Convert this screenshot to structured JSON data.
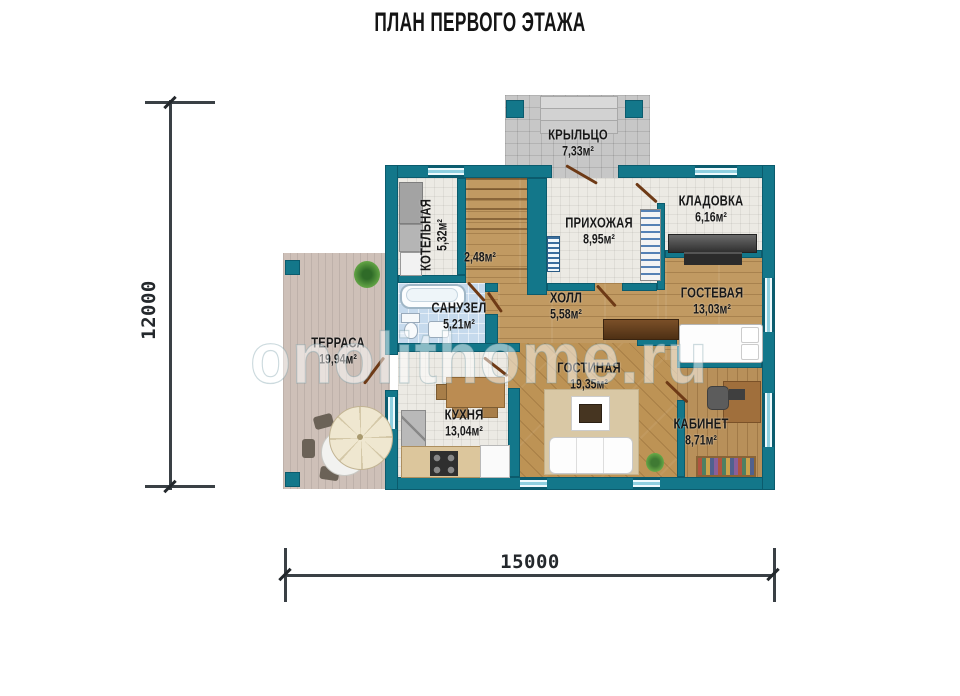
{
  "title": "ПЛАН ПЕРВОГО ЭТАЖА",
  "watermark": "onolithome.ru",
  "dimensions": {
    "height_mm": "12000",
    "width_mm": "15000"
  },
  "rooms": {
    "porch": {
      "name": "КРЫЛЬЦО",
      "area": "7,33м²"
    },
    "boiler": {
      "name": "КОТЕЛЬНАЯ",
      "area": "5,32м²"
    },
    "stairs": {
      "name": "",
      "area": "2,48м²"
    },
    "hallway": {
      "name": "ПРИХОЖАЯ",
      "area": "8,95м²"
    },
    "storage": {
      "name": "КЛАДОВКА",
      "area": "6,16м²"
    },
    "bathroom": {
      "name": "САНУЗЕЛ",
      "area": "5,21м²"
    },
    "hall": {
      "name": "ХОЛЛ",
      "area": "5,58м²"
    },
    "guest_room": {
      "name": "ГОСТЕВАЯ",
      "area": "13,03м²"
    },
    "terrace": {
      "name": "ТЕРРАСА",
      "area": "19,94м²"
    },
    "kitchen": {
      "name": "КУХНЯ",
      "area": "13,04м²"
    },
    "living_room": {
      "name": "ГОСТИНАЯ",
      "area": "19,35м²"
    },
    "office": {
      "name": "КАБИНЕТ",
      "area": "8,71м²"
    }
  },
  "colors": {
    "wall": "#13778a",
    "porch_tile": "#c7c7c7",
    "floor_tile": "#eceae4",
    "bath_tile": "#c6daed",
    "wood": "#c19a62",
    "deck": "#cec0b8",
    "dimension_line": "#3a4045"
  }
}
